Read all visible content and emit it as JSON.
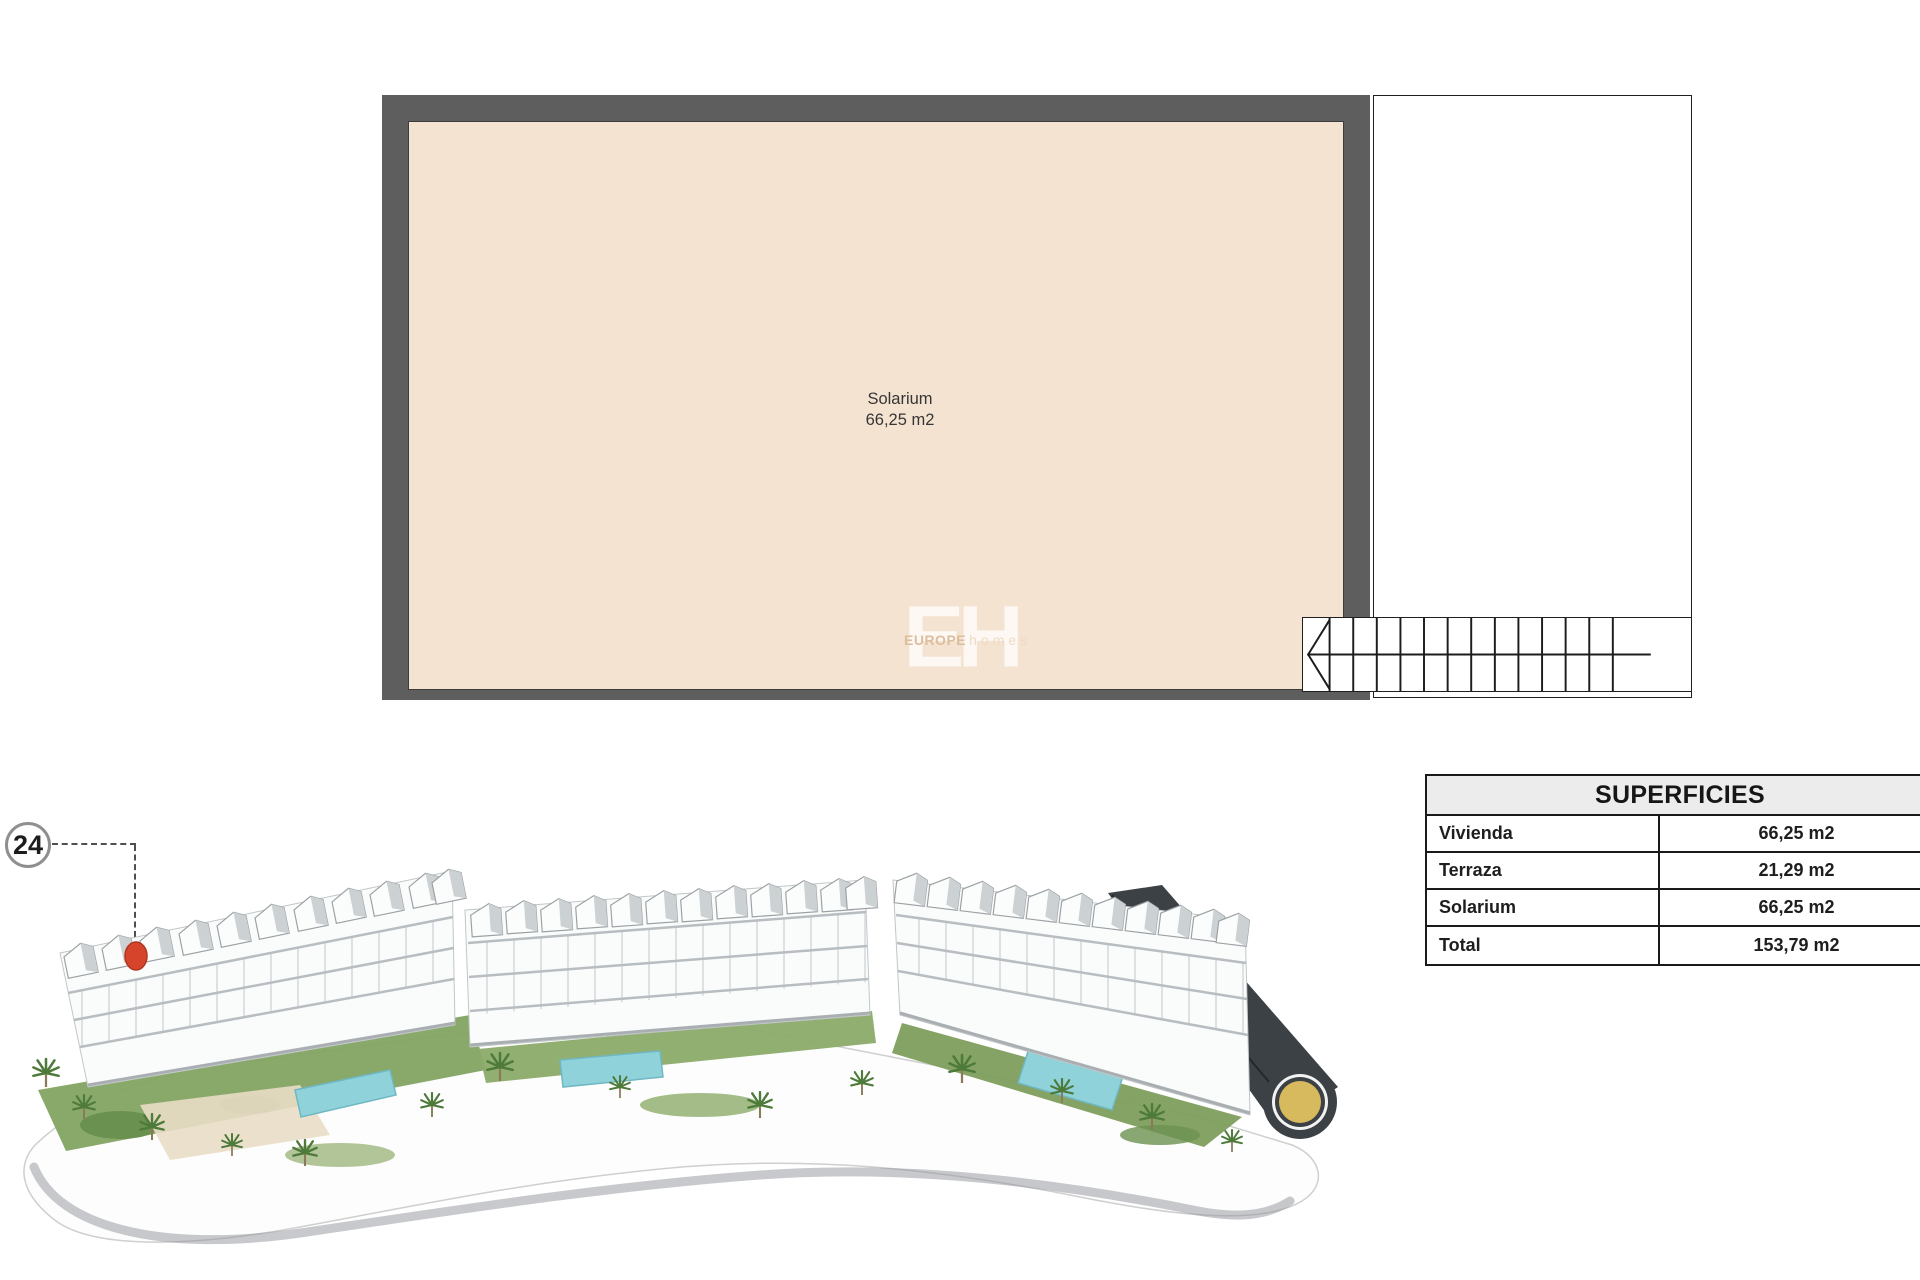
{
  "floor_plan": {
    "room_label": "Solarium",
    "room_area": "66,25 m2",
    "floor_fill_color": "#f5e3d1",
    "wall_color": "#5e5e5e"
  },
  "watermark": {
    "initials": "EH",
    "word1": "EUROPE",
    "word2": "homes"
  },
  "unit_badge": {
    "number": "24",
    "marker_color": "#d6452b"
  },
  "table": {
    "title": "SUPERFICIES",
    "rows": [
      {
        "label": "Vivienda",
        "value": "66,25 m2"
      },
      {
        "label": "Terraza",
        "value": "21,29 m2"
      },
      {
        "label": "Solarium",
        "value": "66,25 m2"
      },
      {
        "label": "Total",
        "value": "153,79 m2"
      }
    ]
  }
}
